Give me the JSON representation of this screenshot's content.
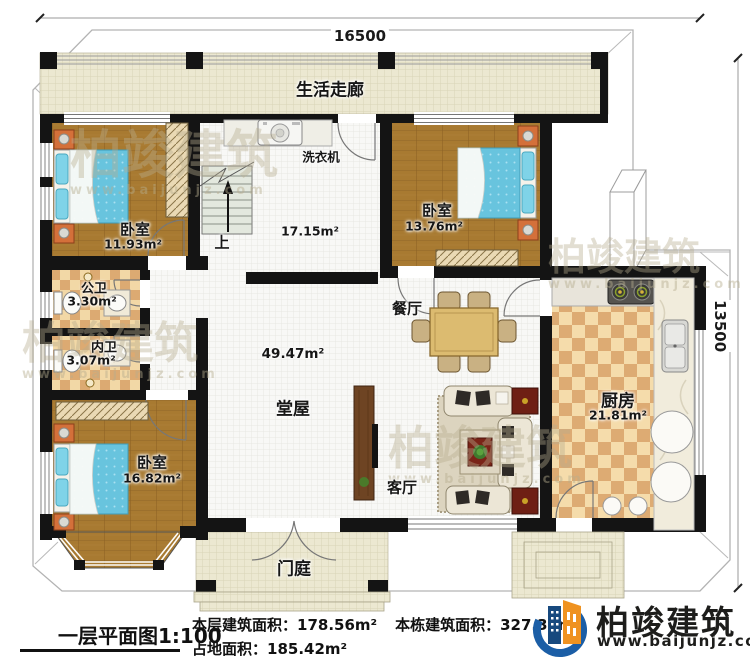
{
  "dimensions": {
    "width_label": "16500",
    "height_label": "13500"
  },
  "rooms": {
    "corridor": {
      "name": "生活走廊"
    },
    "laundry": {
      "appliance": "洗衣机",
      "area": "17.15m²",
      "stair_label": "上"
    },
    "bedroom_top_left": {
      "name": "卧室",
      "area": "11.93m²"
    },
    "bedroom_top_right": {
      "name": "卧室",
      "area": "13.76m²"
    },
    "bedroom_bottom_left": {
      "name": "卧室",
      "area": "16.82m²"
    },
    "bath_public": {
      "name": "公卫",
      "area": "3.30m²"
    },
    "bath_private": {
      "name": "内卫",
      "area": "3.07m²"
    },
    "dining": {
      "name": "餐厅"
    },
    "hall": {
      "name": "堂屋",
      "area": "49.47m²"
    },
    "living": {
      "name": "客厅"
    },
    "kitchen": {
      "name": "厨房",
      "area": "21.81m²"
    },
    "porch": {
      "name": "门庭"
    }
  },
  "footer": {
    "plan_title": "一层平面图1:100",
    "floor_area_label": "本层建筑面积：",
    "floor_area_value": "178.56m²",
    "total_area_label": "本栋建筑面积：",
    "total_area_value": "327.38m²",
    "land_area_label": "占地面积：",
    "land_area_value": "185.42m²"
  },
  "brand": {
    "name": "柏竣建筑",
    "website": "www.baijunjz.com"
  },
  "watermark": {
    "text": "柏竣建筑",
    "subtext": "www.baijunjz.com"
  },
  "colors": {
    "wall": "#141414",
    "wood_floor": "#a87a31",
    "tile_light": "#f2d8a6",
    "tile_dark": "#dcaa72",
    "corridor_floor": "#ece8d1",
    "bed": "#68c4de",
    "accent_orange": "#d4703a",
    "brand_blue": "#1b5ea6",
    "brand_orange": "#ef9220"
  }
}
